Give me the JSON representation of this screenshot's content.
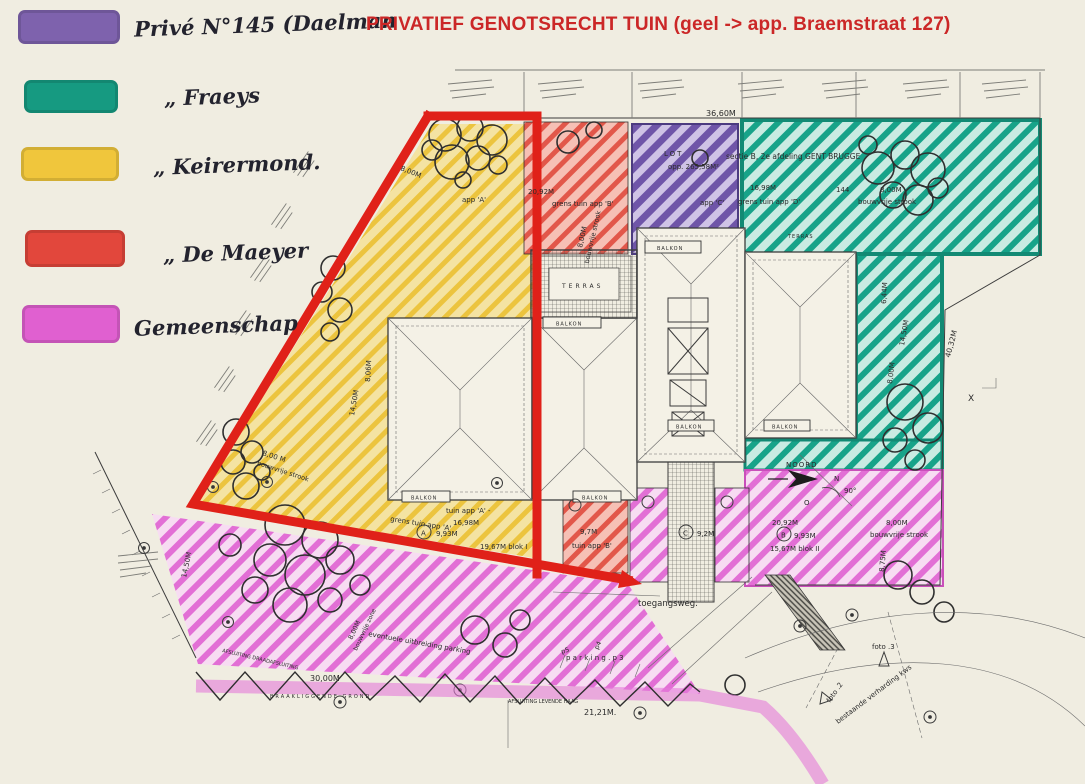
{
  "title": {
    "text": "PRIVATIEF GENOTSRECHT TUIN (geel -> app. Braemstraat 127)",
    "color": "#cb2727"
  },
  "legend": {
    "items": [
      {
        "id": "prive-daelman",
        "color": "#7e62ad",
        "label": "Privé N°145 (Daelman"
      },
      {
        "id": "fraeys",
        "color": "#169a81",
        "label": "„ Fraeys"
      },
      {
        "id": "keirermond",
        "color": "#f0c63c",
        "label": "„ Keirermond."
      },
      {
        "id": "de-maeyer",
        "color": "#e2473c",
        "label": "„ De Maeyer"
      },
      {
        "id": "gemeenschap",
        "color": "#e060d0",
        "label": "Gemeenschap"
      }
    ]
  },
  "plan": {
    "highlight_color": "#e02119",
    "labels": {
      "dim3660": "36,60M",
      "red2092": "20,92M",
      "redGrens": "grens tuin app 'B'",
      "redBouw1": "8,00M",
      "redBouw2": "bouwvrije strook",
      "appC": "app 'C'",
      "lot": "LOT",
      "opp": "opp. 265,58M²",
      "sectie": "sectie B, 2e afdeling GENT BRUGGE",
      "teal1698": "16,98M",
      "teal144": "144",
      "teal800": "8,00M",
      "tealBouw": "bouwvrije strook",
      "tealGrens": "grens tuin app 'D'",
      "terrasSmall": "TERRAS",
      "y800": "8,00M",
      "appA": "app 'A'",
      "y806": "8,06M",
      "y1450": "14,50M",
      "yb800": "8,00 M",
      "ybBouw": "bouwvrije strook",
      "grensA": "grens  tuin app 'A'",
      "tuinA": "tuin app 'A' -",
      "a1698": "16,98M",
      "a993": "9,93M",
      "blokI": "19,67M blok I",
      "r97": "9,7M",
      "rTuinB": "tuin app 'B'",
      "c92": "9,2M",
      "m2092": "20,92M",
      "m993": "9,93M",
      "blokII": "15,67M blok II",
      "m800": "8,00M",
      "mBouw": "bouwvrije strook",
      "m875": "8,75M",
      "noord": "NOORD",
      "nN": "N",
      "deg90": "90°",
      "oO": "O",
      "t644": "6,44M",
      "t1450": "14,50M",
      "t800": "8,00M",
      "t4032": "40,32M",
      "xX": "X",
      "toegang": "toegangsweg.",
      "parkingP3": "p a r k i n g .  p 3",
      "p4": "p4",
      "p5": "p5",
      "dim2121": "21,21M.",
      "haag": "AFSLUITING  LEVENDE  HAAG",
      "dim3000": "30,00M",
      "braak": "BRAAKLIGGENDE  GROND",
      "draad": "AFSLUITING  DRAADAFSLUITING",
      "uitbr": "eventuele uitbreiding parking",
      "zone800a": "8,00M",
      "zone800b": "bouwvrije zone",
      "l1450": "14,50M",
      "foto2": "foto .2",
      "foto3": "foto .3",
      "verh": "bestaande verharding kws",
      "balkon": "BALKON",
      "terras": "TERRAS"
    },
    "markers": {
      "a": "A",
      "b": "B",
      "c": "C"
    }
  }
}
